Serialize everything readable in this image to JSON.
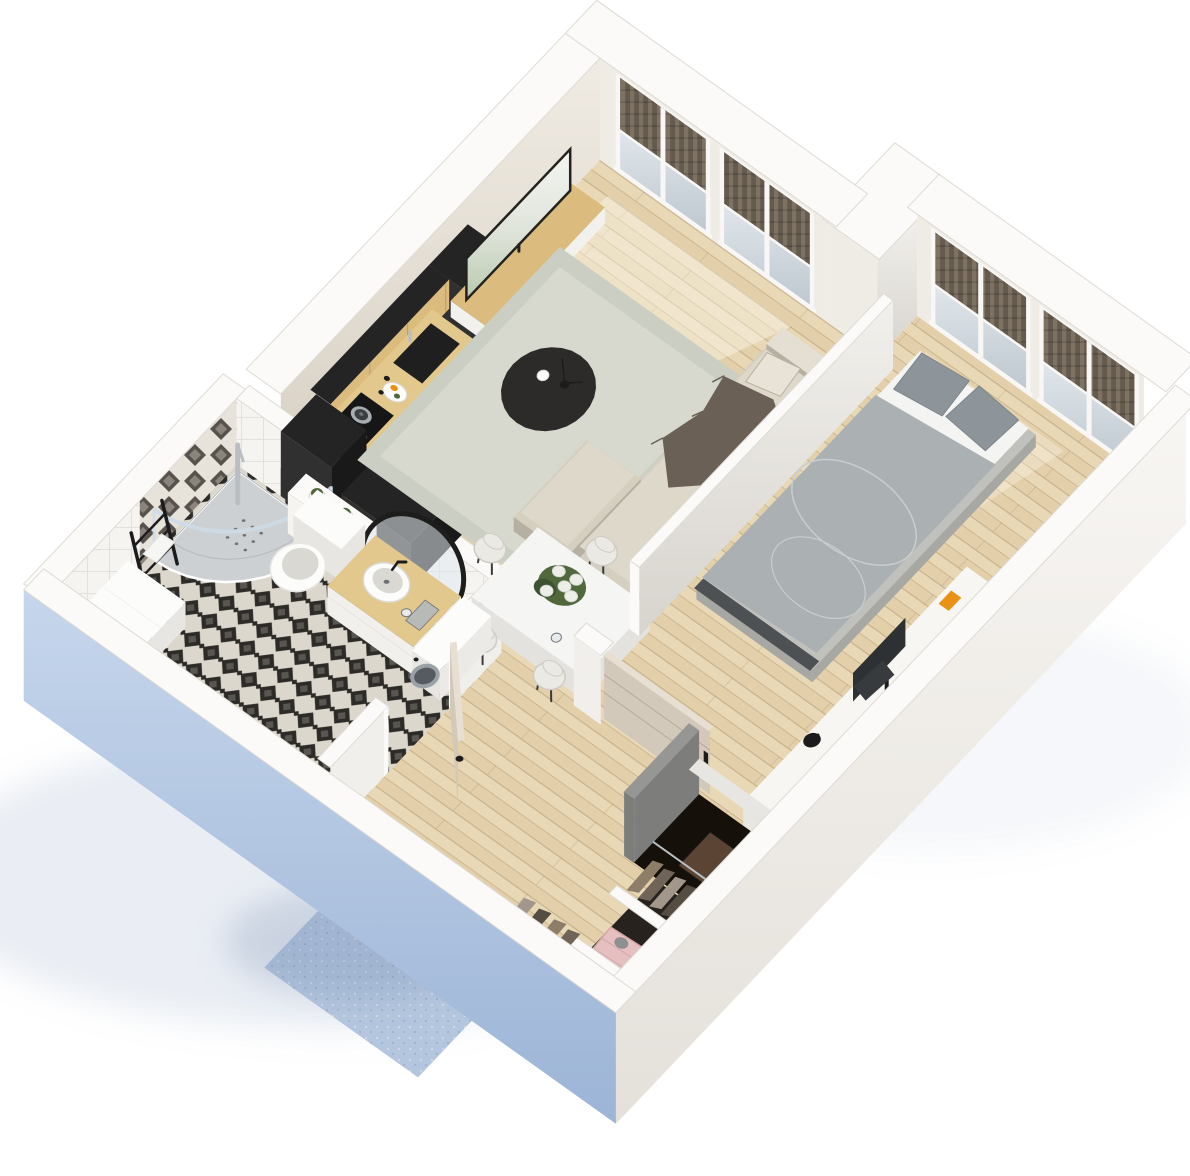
{
  "scene": {
    "kind": "3d-apartment-floorplan-render",
    "view": "isometric-cutaway-top",
    "background": "#ffffff"
  },
  "rooms": [
    {
      "id": "living-room",
      "items": [
        "tv-screen",
        "tv-console",
        "area-rug",
        "round-coffee-table",
        "decor-vases",
        "corner-sofa",
        "throw-blanket",
        "balcony-windows"
      ]
    },
    {
      "id": "kitchen",
      "items": [
        "tall-black-cabinet",
        "wood-front-cabinets",
        "countertop",
        "black-sink",
        "faucet",
        "cooktop",
        "pots",
        "fruit-plate",
        "spice-jars",
        "fridge-cabinet",
        "jar-shelf",
        "black-island"
      ]
    },
    {
      "id": "dining-area",
      "items": [
        "white-table",
        "white-chairs",
        "flower-bouquet",
        "juice-jug",
        "water-glass"
      ]
    },
    {
      "id": "bedroom",
      "items": [
        "double-bed",
        "gray-pillows",
        "gray-duvet",
        "white-sheet",
        "desk",
        "monitor",
        "keyboard",
        "desk-lamp",
        "balcony-windows",
        "sliding-door"
      ]
    },
    {
      "id": "bathroom",
      "items": [
        "corner-shower",
        "shower-glass",
        "shower-column",
        "towel-ladder",
        "white-cabinet",
        "wall-hung-toilet",
        "succulent-plants",
        "vanity-sink",
        "round-black-mirror",
        "washing-machine",
        "folded-towels",
        "patterned-tile-floor",
        "open-door"
      ]
    },
    {
      "id": "hallway",
      "items": [
        "entrance-door",
        "blue-corridor-floor",
        "gray-divider-wall",
        "dark-closet-niche",
        "hanging-clothes",
        "pink-bedding-niche",
        "wardrobe-dividers"
      ]
    }
  ],
  "openings": {
    "living_windows": 2,
    "bedroom_windows": 2,
    "entrance_doors": 1,
    "bathroom_doors": 1,
    "sliding_doors": 1
  },
  "palette": {
    "bg": "#ffffff",
    "shadowBlue": "rgba(126,150,186,0.16)",
    "shadowBlue2": "rgba(96,120,160,0.22)",
    "rim": "#fbfaf8",
    "rimLine": "#dedbd5",
    "greigeHi": "#f0ebe3",
    "greigeLo": "#d6cfc3",
    "facadeInner": "#efece6",
    "frameWhite": "#f8f7f5",
    "blindDark": "#655a4e",
    "blindLite": "#7e7263",
    "glassHi": "#e0e6eb",
    "glassLo": "#bfc8d0",
    "blueHi": "#c6d6ec",
    "blueLo": "#9cb4d6",
    "whiteFaceHi": "#f8f6f3",
    "whiteFaceLo": "#e4e0da",
    "bathWestHi": "#eff2f7",
    "bathWestLo": "#dce3ed",
    "innerWallLite": "#f1efeb",
    "partitionHi": "#f2f0ec",
    "partitionLo": "#d7d4ce",
    "woodBase": "#e8d8b6",
    "woodAlt": "#ddc9a2",
    "woodLine": "rgba(146,116,74,0.40)",
    "tileCream": "#dcd7cc",
    "tileBlack": "#2d2b28",
    "wallTileWhite": "#f5f4f1",
    "wallTileLine": "#e4e1dc",
    "diamondBg": "#e7e2da",
    "diamondDark": "#57524c",
    "consoleWood": "#dcbc7e",
    "consoleWhite": "#f3f1ed",
    "nicheDark": "#3a342c",
    "tvDark": "#23221f",
    "tvSkyA": "#f4f5f2",
    "tvSkyB": "#dfe4da",
    "tvGreen": "#b9c9ae",
    "counterWood": "#e3c88e",
    "lowerDark": "#3a3a3c",
    "lowerDark2": "#2c2c2e",
    "sinkBlack": "#1f1f1f",
    "cooktop": "#161616",
    "steel": "#a8adb1",
    "steelDark": "#3c3f41",
    "blackTop": "#242424",
    "blackU": "#191919",
    "blackV": "#303030",
    "rugA": "#cbcec3",
    "rugB": "#d7d9ce",
    "tableBlack": "#2c2b2a",
    "sofaBase": "#d5cfc0",
    "sofaMid": "#ded8ca",
    "sofaLite": "#e4dfd2",
    "sofaShadow": "#b6b0a2",
    "pillowBeige": "#e8e3d6",
    "throw": "#6a6055",
    "tableWhite": "#f5f5f3",
    "tableSide": "#e3e2de",
    "tableLeg": "#3a3a3a",
    "chairWhite": "#ebe9e4",
    "chairEdge": "#cfccc5",
    "leafGreen": "#51683c",
    "leafDark": "#3c5230",
    "bloomWhite": "#edeee8",
    "bloomEdge": "#d8dbd2",
    "orange": "#e89114",
    "glassLite": "#e7ebee",
    "doorGreige": "#d2c9ba",
    "doorGreigeDk": "#bfb5a4",
    "doorTop": "#e6dfd2",
    "doorSeam": "rgba(110,95,70,0.28)",
    "grayWall": "#969694",
    "grayWallDk": "#7d7d7b",
    "nicheBlack": "#151009",
    "brownItem": "#5b4434",
    "wardBase": "#27221d",
    "cloth1": "#8e7e69",
    "cloth2": "#6f6457",
    "cloth3": "#a3968a",
    "cloth4": "#554c42",
    "clothBag": "#c3ad8c",
    "pinkQuilt": "#e6c0c1",
    "pinkLine": "#d3a6a8",
    "grayCloth": "#8d8f91",
    "entryDoor": "#343943",
    "entryFrame": "#23262d",
    "bedBase": "#c0c0bd",
    "bedSideDk": "#a7a7a3",
    "duvet": "#abb0b3",
    "duvetLine": "#c9cdcf",
    "pillowGray": "#8d959a",
    "pillowEdge": "#7d858a",
    "sheetWhite": "#f4f4f2",
    "bedFrameDark": "#4e5154",
    "deskWhite": "#f7f6f3",
    "deskSide": "#e8e6e1",
    "monitorDark": "#2e3134",
    "keyDark": "#383b3e",
    "chrome": "#b9bec2",
    "dark": "#1c1c1c",
    "mid": "#6f7377",
    "white": "#fcfcfb",
    "whiteShade": "#e7e6e2",
    "whiteShade2": "#d9d8d3",
    "trayGray": "#ccd0d2",
    "trayLine": "#b8bcbe",
    "glassEdge": "rgba(205,220,232,0.85)",
    "potWhite": "#f1f0ec",
    "towelGray": "#b7bab6",
    "towelWhite": "#f6f6f4",
    "washRing": "#9aa1a7",
    "washGlass": "#555b60",
    "washFace": "#eceae6",
    "vanityWhite": "#f2f0ec",
    "mirrorBlack": "#1d1d1c",
    "mirrorGlass": "rgba(226,233,238,0.55)",
    "corridorBlue": "#b4c6de",
    "sun": "rgba(255,252,242,0.38)"
  }
}
